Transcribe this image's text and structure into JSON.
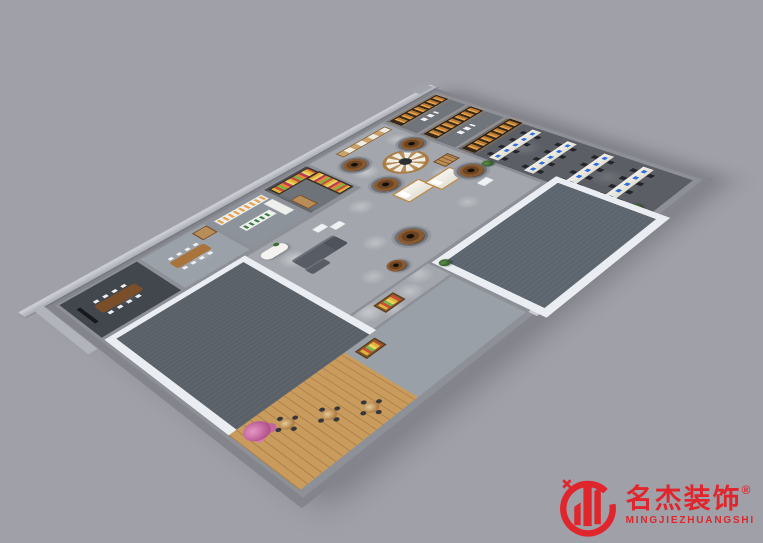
{
  "scene": {
    "background_color": "#a0a0a8",
    "subject": "3D aerial cutaway render of an office showroom floor plan"
  },
  "watermark": {
    "brand_cn": "名杰装饰",
    "registered_mark": "®",
    "brand_en": "MINGJIEZHUANGSHI",
    "brand_color": "#e0252c"
  },
  "palette": {
    "wall": "#8e9098",
    "wall_light": "#ced1d7",
    "hall_floor": "#a3a7ad",
    "office_floor": "#5b5e65",
    "vacant_floor": "#596067",
    "white_trim": "#eaedf1",
    "wood": "#b98d57",
    "wood_dark": "#6b4423",
    "vase_brown": "#7b4e27",
    "mattress": "#f2efe8",
    "monitor_blue": "#2f6fe0",
    "chair_black": "#24262b",
    "shelf_glow": "#e6a24c",
    "dining_wood": "#c99b5c",
    "blossom": "#b4538f",
    "plant": "#3f6b33",
    "brand_red": "#e0252c"
  },
  "scene_elements": {
    "vase_sculptures": 6,
    "office_desk_clusters": 4,
    "dining_tables": 3,
    "vacant_carpet_rooms": 2,
    "glowing_bookshelf_rooms": 2
  }
}
